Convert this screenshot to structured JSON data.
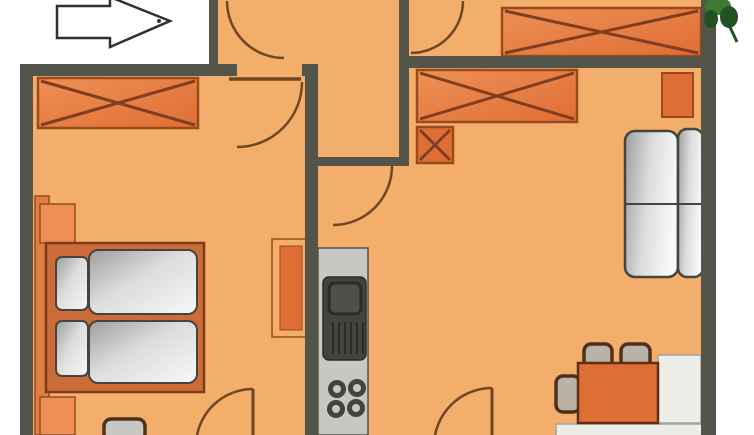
{
  "title": "apartment-floor-plan",
  "palette": {
    "background_white": "#FFFFFF",
    "floor": "#F2AE6A",
    "wall": "#53544A",
    "furniture_orange": "#DF6E34",
    "furniture_orange_light": "#EE9055",
    "furniture_outline": "#9A4A1E",
    "cross_line": "#7E3E1F",
    "headboard": "#DE7F41",
    "bed_frame": "#CC6C38",
    "bed_frame_outline": "#7E3B1A",
    "textile_dark": "#9E9E9E",
    "textile_mid": "#DCDCDC",
    "textile_light": "#F8F8F8",
    "textile_outline": "#45453F",
    "counter_gray": "#C8C7C3",
    "appliance_dark": "#44443F",
    "appliance_mid": "#50504A",
    "appliance_outline": "#2B2B28",
    "bench_white": "#EDEDE8",
    "bench_outline": "#A5A29A",
    "chair_fill": "#B9B2A6",
    "chair_brown": "#4F3118",
    "table_outline": "#5E2F15",
    "door_arc": "#6F4722",
    "plant_green": "#3B7A33",
    "plant_green_dark": "#205223",
    "arrow_outline": "#2F2F2F"
  },
  "objects": [
    {
      "name": "entrance-arrow"
    },
    {
      "name": "entrance-door-swing"
    },
    {
      "name": "hall-door-swing"
    },
    {
      "name": "bedroom-door-swing"
    },
    {
      "name": "kitchen-door-swing"
    },
    {
      "name": "bedroom-lower-door-swing"
    },
    {
      "name": "living-lower-door-swing"
    },
    {
      "name": "bedroom-wardrobe"
    },
    {
      "name": "hall-wardrobe"
    },
    {
      "name": "living-room-wardrobe"
    },
    {
      "name": "shoe-cabinet"
    },
    {
      "name": "double-bed"
    },
    {
      "name": "pillows"
    },
    {
      "name": "duvets"
    },
    {
      "name": "nightstands"
    },
    {
      "name": "dresser"
    },
    {
      "name": "stool"
    },
    {
      "name": "kitchen-counter"
    },
    {
      "name": "sink-unit"
    },
    {
      "name": "cooktop-burners"
    },
    {
      "name": "sofa"
    },
    {
      "name": "side-table"
    },
    {
      "name": "dining-table"
    },
    {
      "name": "chairs"
    },
    {
      "name": "corner-bench"
    },
    {
      "name": "potted-plant"
    }
  ]
}
